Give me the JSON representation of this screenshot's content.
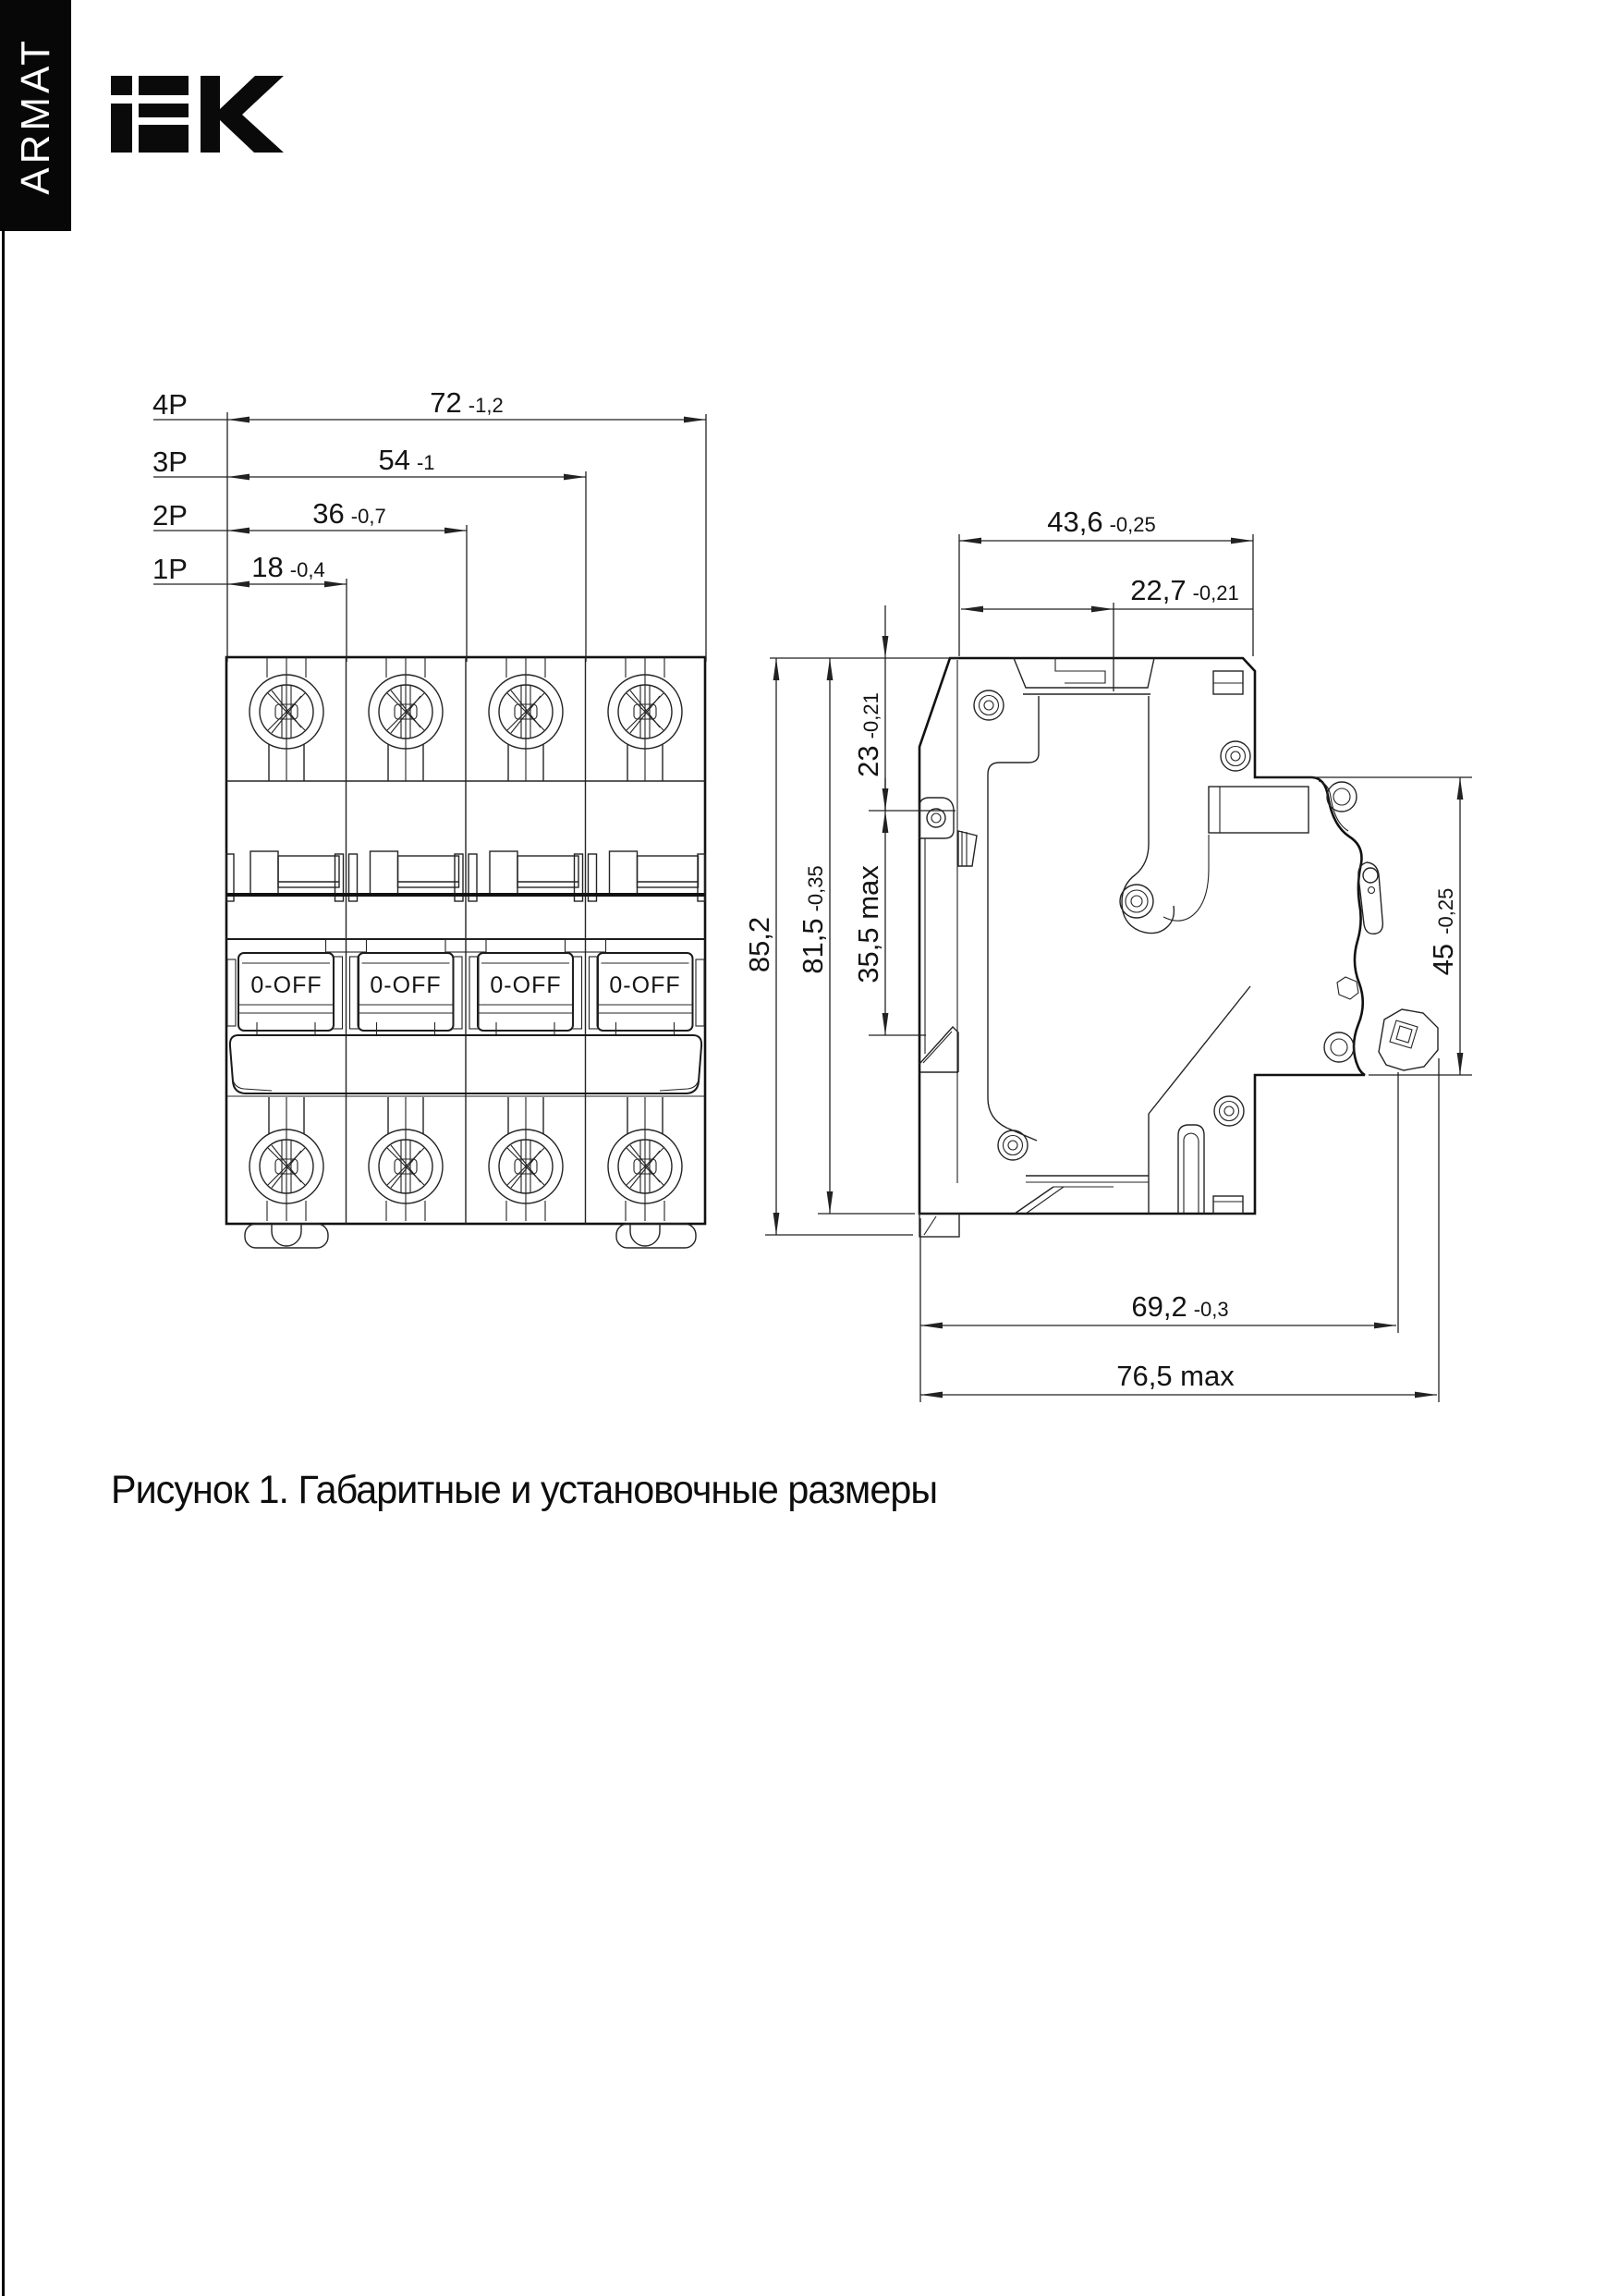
{
  "brand": {
    "vertical_label": "ARMAT",
    "logo_name": "IEK"
  },
  "caption": "Рисунок 1. Габаритные и установочные размеры",
  "front_view": {
    "rows": [
      {
        "pole": "4P",
        "value": "72",
        "tol": "-1,2"
      },
      {
        "pole": "3P",
        "value": "54",
        "tol": "-1"
      },
      {
        "pole": "2P",
        "value": "36",
        "tol": "-0,7"
      },
      {
        "pole": "1P",
        "value": "18",
        "tol": "-0,4"
      }
    ],
    "toggle_label": "0-OFF"
  },
  "side_view": {
    "dims": {
      "overall_width": {
        "value": "43,6",
        "tol": "-0,25"
      },
      "rail_offset": {
        "value": "22,7",
        "tol": "-0,21"
      },
      "top_to_rail": {
        "value": "23",
        "tol": "-0,21"
      },
      "clip_zone": {
        "value": "35,5 max",
        "tol": ""
      },
      "overall_height": {
        "value": "85,2",
        "tol": ""
      },
      "body_height": {
        "value": "81,5",
        "tol": "-0,35"
      },
      "panel_cutout": {
        "value": "45",
        "tol": "-0,25"
      },
      "depth": {
        "value": "69,2",
        "tol": "-0,3"
      },
      "depth_max": {
        "value": "76,5 max",
        "tol": ""
      }
    }
  },
  "colors": {
    "ink": "#141414",
    "banner_bg": "#070707",
    "banner_fg": "#ffffff",
    "paper": "#ffffff"
  }
}
